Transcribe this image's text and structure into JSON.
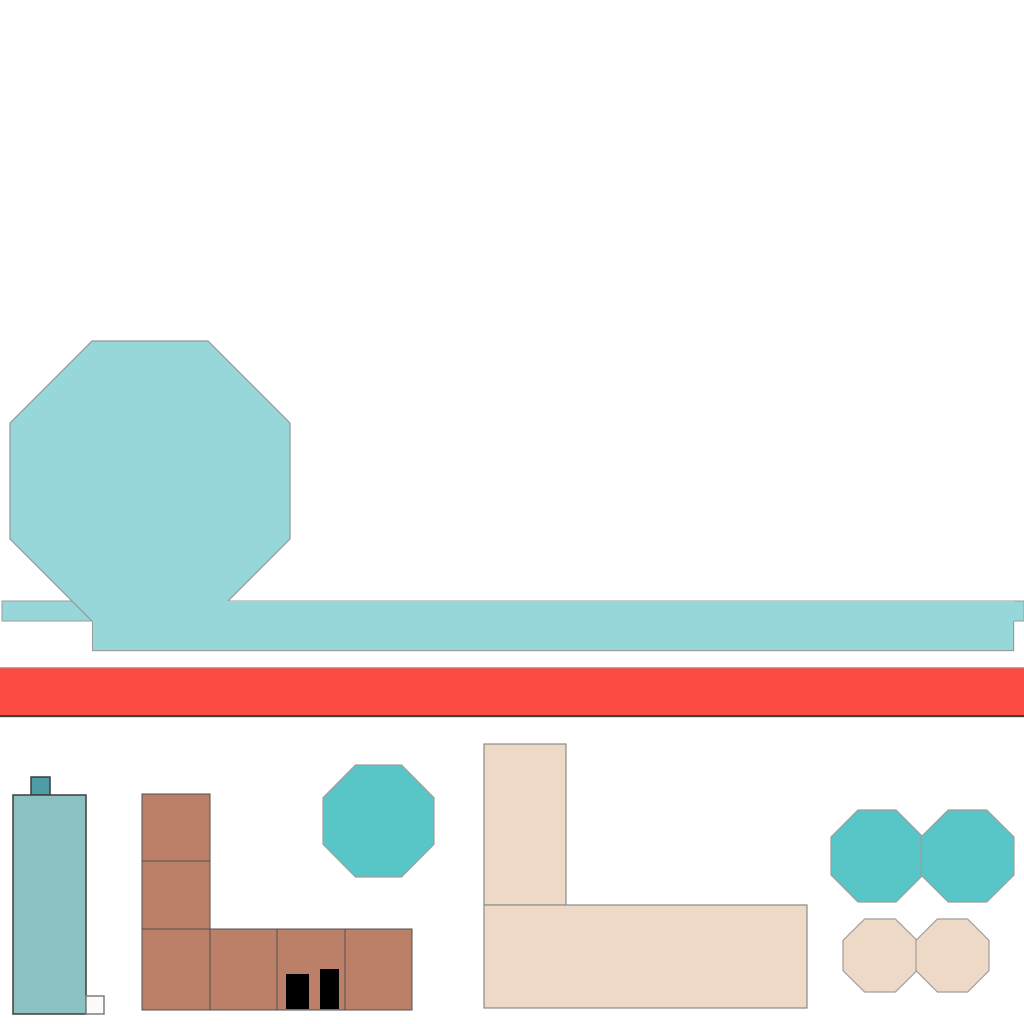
{
  "scene": {
    "width": 1024,
    "height": 1024,
    "background": "#ffffff",
    "palette": {
      "light_teal": "#97d7d9",
      "teal": "#58c5c6",
      "building_teal": "#8cc1c2",
      "chimney_teal": "#4d9da4",
      "brown": "#bc8068",
      "beige": "#edd9c6",
      "red": "#fb4b42",
      "door_black": "#000000",
      "door_white": "#fbfbfb",
      "edge_gray": "#9b9b9b",
      "edge_dark": "#3d3d3d"
    },
    "shapes": [
      {
        "name": "sky-bar-thin",
        "kind": "rect",
        "x": 2,
        "y": 601,
        "w": 1022,
        "h": 20,
        "fill": "#97d7d9",
        "stroke": "#9b9b9b",
        "sw": 1
      },
      {
        "name": "large-light-octagon",
        "kind": "octagon",
        "x": 10,
        "y": 341,
        "w": 280,
        "h": 280,
        "fill": "#97d7d9",
        "stroke": "#979797",
        "sw": 1.2
      },
      {
        "name": "sky-bar-thick",
        "kind": "rect",
        "x": 92,
        "y": 601,
        "w": 922,
        "h": 50,
        "fill": "#97d7d9",
        "stroke": "none",
        "sw": 0
      },
      {
        "name": "sky-bar-bottom-edge",
        "kind": "rect",
        "x": 92,
        "y": 650,
        "w": 922,
        "h": 1.2,
        "fill": "#9b9b9b",
        "stroke": "none",
        "sw": 0
      },
      {
        "name": "sky-bar-left-edge",
        "kind": "rect",
        "x": 92,
        "y": 621,
        "w": 1,
        "h": 30,
        "fill": "#9b9b9b",
        "stroke": "none",
        "sw": 0
      },
      {
        "name": "sky-bar-right-edge",
        "kind": "rect",
        "x": 1013,
        "y": 621,
        "w": 1.2,
        "h": 30,
        "fill": "#9b9b9b",
        "stroke": "none",
        "sw": 0
      },
      {
        "name": "red-stripe",
        "kind": "rect",
        "x": 0,
        "y": 668,
        "w": 1024,
        "h": 48,
        "fill": "#fb4b42",
        "stroke": "none",
        "sw": 0
      },
      {
        "name": "red-stripe-top-edge",
        "kind": "rect",
        "x": 0,
        "y": 667,
        "w": 1024,
        "h": 1.3,
        "fill": "#a8a8a8",
        "stroke": "none",
        "sw": 0
      },
      {
        "name": "red-stripe-bottom-edge",
        "kind": "rect",
        "x": 0,
        "y": 715,
        "w": 1024,
        "h": 2.2,
        "fill": "#3f3f3f",
        "stroke": "none",
        "sw": 0
      },
      {
        "name": "teal-building-chimney",
        "kind": "rect",
        "x": 31,
        "y": 777,
        "w": 19,
        "h": 18,
        "fill": "#4d9da4",
        "stroke": "#3d3d3d",
        "sw": 1.5
      },
      {
        "name": "teal-building-body",
        "kind": "rect",
        "x": 13,
        "y": 795,
        "w": 73,
        "h": 219,
        "fill": "#8cc1c2",
        "stroke": "#3d3d3d",
        "sw": 1.5
      },
      {
        "name": "teal-building-white-door",
        "kind": "rect",
        "x": 86,
        "y": 996,
        "w": 18,
        "h": 18,
        "fill": "#fbfbfb",
        "stroke": "#7d7d7d",
        "sw": 1.5
      },
      {
        "name": "brown-block-top",
        "kind": "rect",
        "x": 142,
        "y": 794,
        "w": 68,
        "h": 67,
        "fill": "#bc8068",
        "stroke": "#4f4f4f",
        "sw": 1
      },
      {
        "name": "brown-block-mid",
        "kind": "rect",
        "x": 142,
        "y": 861,
        "w": 68,
        "h": 68,
        "fill": "#bc8068",
        "stroke": "#4f4f4f",
        "sw": 1
      },
      {
        "name": "brown-block-base-1",
        "kind": "rect",
        "x": 142,
        "y": 929,
        "w": 68,
        "h": 81,
        "fill": "#bc8068",
        "stroke": "#4f4f4f",
        "sw": 1
      },
      {
        "name": "brown-block-base-2",
        "kind": "rect",
        "x": 210,
        "y": 929,
        "w": 67,
        "h": 81,
        "fill": "#bc8068",
        "stroke": "#4f4f4f",
        "sw": 1
      },
      {
        "name": "brown-block-base-3",
        "kind": "rect",
        "x": 277,
        "y": 929,
        "w": 68,
        "h": 81,
        "fill": "#bc8068",
        "stroke": "#4f4f4f",
        "sw": 1
      },
      {
        "name": "brown-block-base-4",
        "kind": "rect",
        "x": 345,
        "y": 929,
        "w": 67,
        "h": 81,
        "fill": "#bc8068",
        "stroke": "#4f4f4f",
        "sw": 1
      },
      {
        "name": "brown-building-door-1",
        "kind": "rect",
        "x": 286,
        "y": 974,
        "w": 23,
        "h": 35,
        "fill": "#000000",
        "stroke": "none",
        "sw": 0
      },
      {
        "name": "brown-building-door-2",
        "kind": "rect",
        "x": 320,
        "y": 969,
        "w": 19,
        "h": 40,
        "fill": "#000000",
        "stroke": "none",
        "sw": 0
      },
      {
        "name": "small-teal-octagon",
        "kind": "octagon",
        "x": 323,
        "y": 765,
        "w": 111,
        "h": 112,
        "fill": "#58c5c6",
        "stroke": "#9e9e9e",
        "sw": 1.2
      },
      {
        "name": "beige-tower",
        "kind": "rect",
        "x": 484,
        "y": 744,
        "w": 82,
        "h": 161,
        "fill": "#edd9c6",
        "stroke": "#8a8a8a",
        "sw": 1.2
      },
      {
        "name": "beige-base",
        "kind": "rect",
        "x": 484,
        "y": 905,
        "w": 323,
        "h": 103,
        "fill": "#edd9c6",
        "stroke": "#8a8a8a",
        "sw": 1.2
      },
      {
        "name": "teal-octagon-pair-left",
        "kind": "octagon",
        "x": 831,
        "y": 810,
        "w": 92,
        "h": 92,
        "fill": "#58c5c6",
        "stroke": "#9e9e9e",
        "sw": 1.2
      },
      {
        "name": "teal-octagon-pair-right",
        "kind": "octagon",
        "x": 921,
        "y": 810,
        "w": 93,
        "h": 92,
        "fill": "#58c5c6",
        "stroke": "#9e9e9e",
        "sw": 1.2
      },
      {
        "name": "beige-octagon-pair-left",
        "kind": "octagon",
        "x": 843,
        "y": 919,
        "w": 74,
        "h": 73,
        "fill": "#edd9c6",
        "stroke": "#9e9e9e",
        "sw": 1.2
      },
      {
        "name": "beige-octagon-pair-right",
        "kind": "octagon",
        "x": 916,
        "y": 919,
        "w": 73,
        "h": 73,
        "fill": "#edd9c6",
        "stroke": "#9e9e9e",
        "sw": 1.2
      }
    ]
  }
}
